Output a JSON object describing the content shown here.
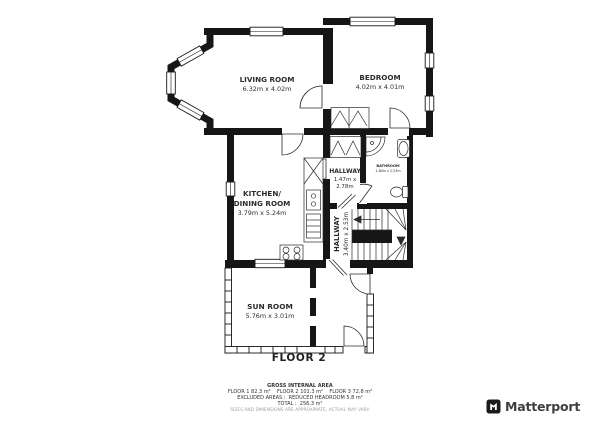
{
  "colors": {
    "wall": "#161616",
    "line": "#2b2b2b",
    "text": "#2c2c2c",
    "muted": "#a2a2a2"
  },
  "plan": {
    "living_room": {
      "name": "LIVING ROOM",
      "dims": "6.32m x 4.02m"
    },
    "bedroom": {
      "name": "BEDROOM",
      "dims": "4.02m x 4.01m"
    },
    "kitchen": {
      "line1": "KITCHEN/",
      "line2": "DINING ROOM",
      "dims": "3.79m x 5.24m"
    },
    "hallway_upper": {
      "name": "HALLWAY",
      "dims1": "1.47m x",
      "dims2": "2.78m"
    },
    "bathroom": {
      "name": "BATHROOM",
      "dims": "1.80m x 2.53m"
    },
    "hallway_lower": {
      "name": "HALLWAY",
      "dims": "3.40m x 2.53m"
    },
    "sun_room": {
      "name": "SUN ROOM",
      "dims": "5.76m x 3.01m"
    },
    "floor_label": "FLOOR 2"
  },
  "footer": {
    "title": "GROSS INTERNAL AREA",
    "floors": "FLOOR 1 82.3 m²    FLOOR 2 101.3 m²    FLOOR 3 72.8 m²",
    "excluded": "EXCLUDED AREAS :  REDUCED HEADROOM 5.8 m²",
    "total": "TOTAL :  256.3 m²",
    "disclaimer": "SIZES AND DIMENSIONS ARE APPROXIMATE, ACTUAL MAY VARY."
  },
  "brand": {
    "name": "Matterport"
  }
}
